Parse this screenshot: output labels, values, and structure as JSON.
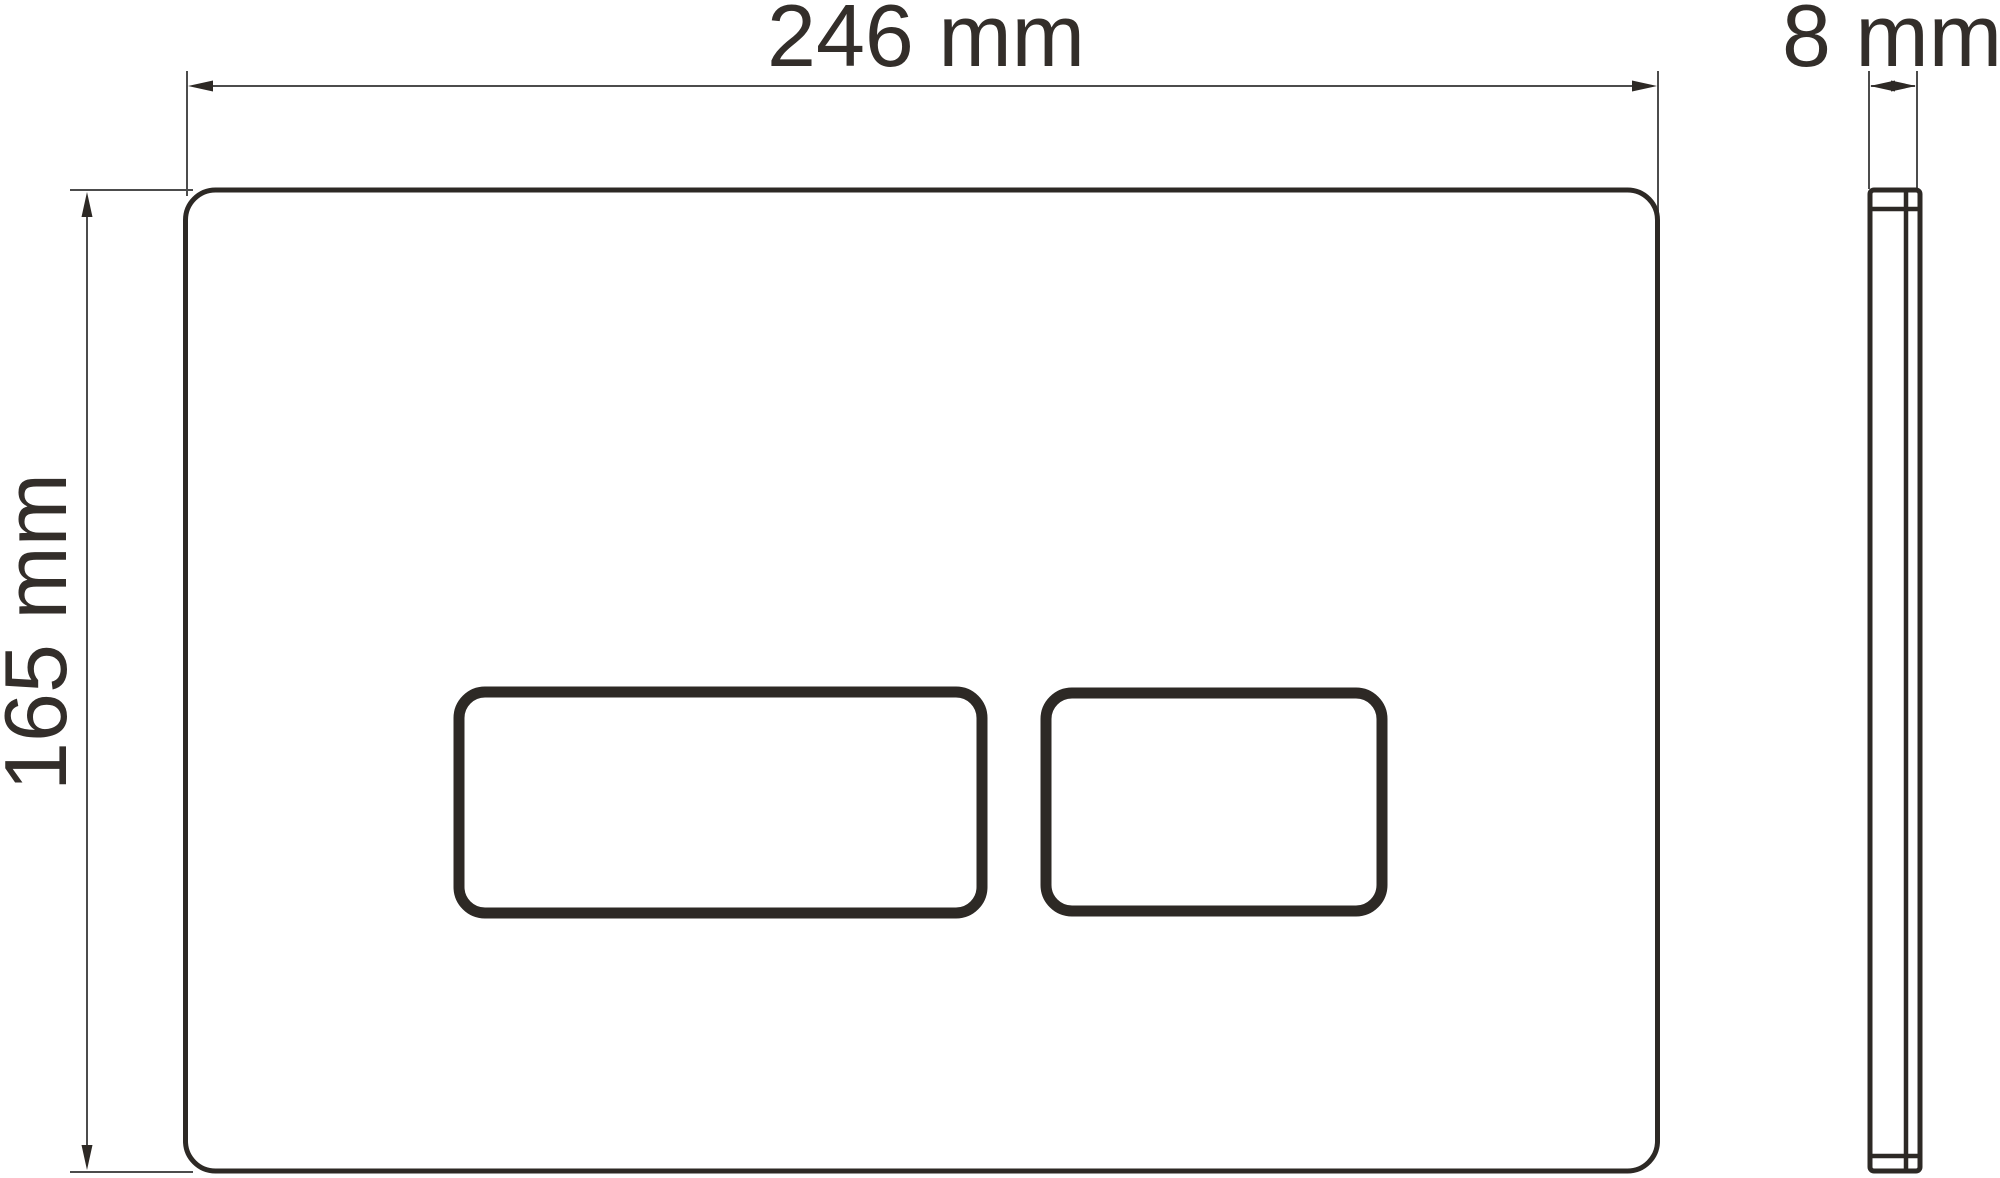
{
  "colors": {
    "background": "#ffffff",
    "line_dark": "#2d2925",
    "line_thin": "#4c4c4c",
    "text": "#332e2a"
  },
  "dimensions": {
    "width": {
      "label": "246 mm",
      "value": 246,
      "unit": "mm"
    },
    "height": {
      "label": "165 mm",
      "value": 165,
      "unit": "mm"
    },
    "depth": {
      "label": "8 mm",
      "value": 8,
      "unit": "mm"
    }
  }
}
